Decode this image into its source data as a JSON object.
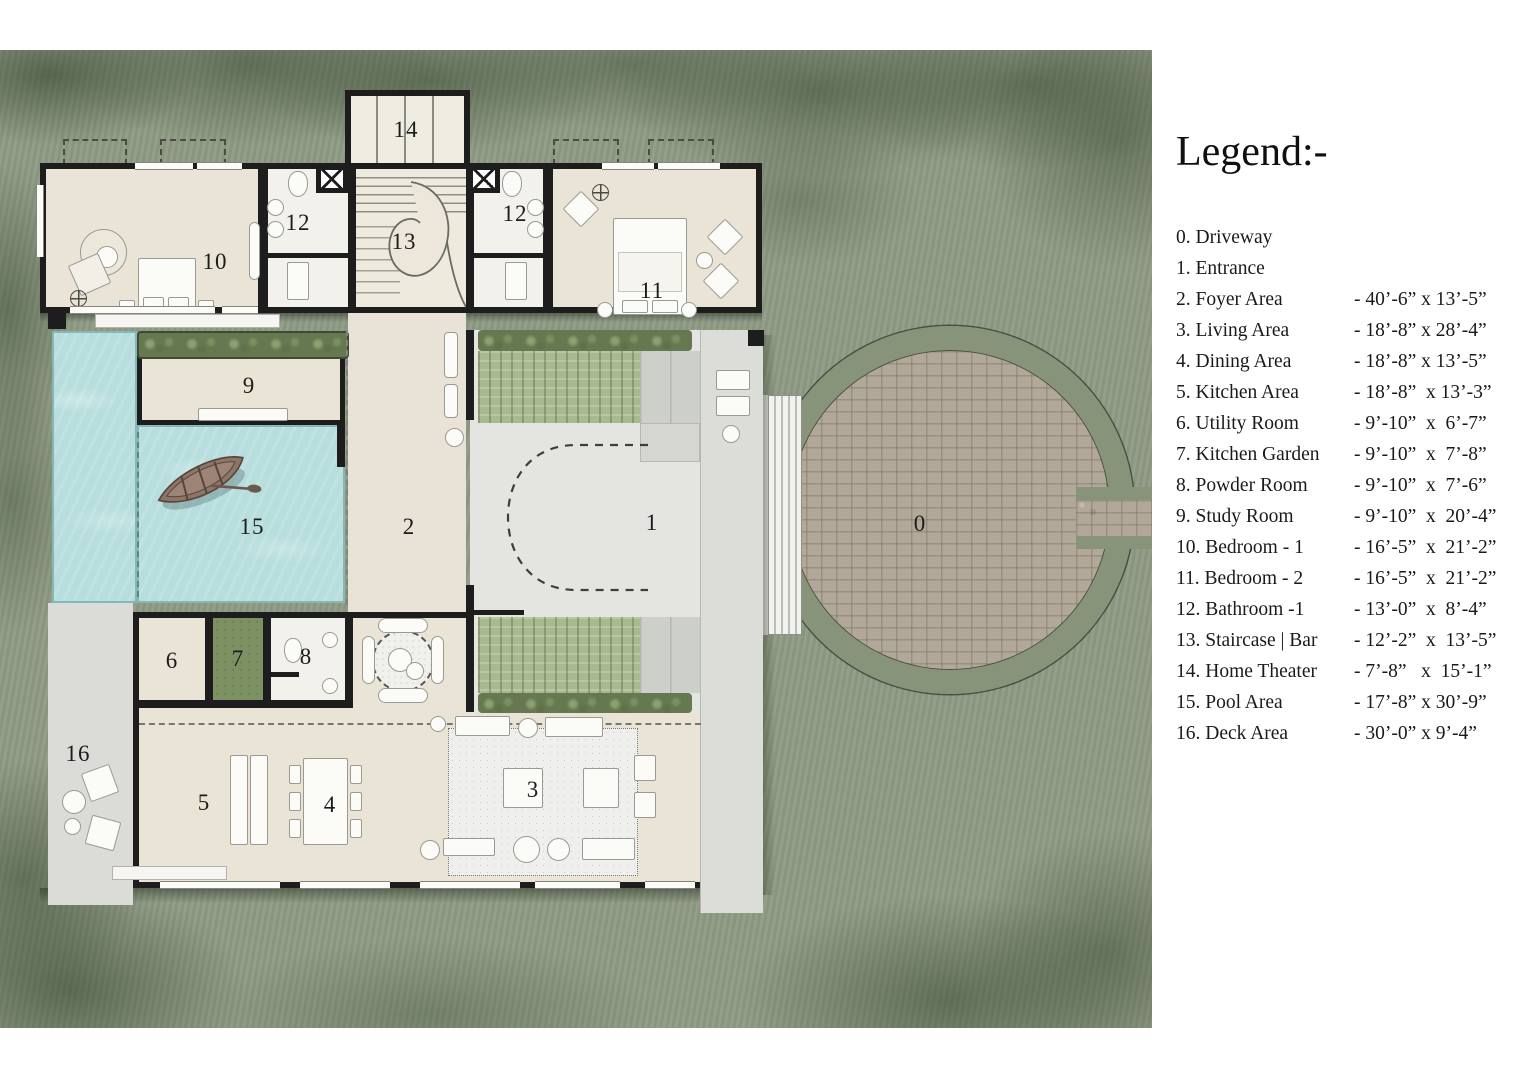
{
  "legend": {
    "title": "Legend:-",
    "items": [
      {
        "label": "0. Driveway",
        "dims": ""
      },
      {
        "label": "1. Entrance",
        "dims": ""
      },
      {
        "label": "2. Foyer Area",
        "dims": "- 40’-6” x 13’-5”"
      },
      {
        "label": "3. Living Area",
        "dims": "- 18’-8” x 28’-4”"
      },
      {
        "label": "4. Dining Area",
        "dims": "- 18’-8” x 13’-5”"
      },
      {
        "label": "5. Kitchen Area",
        "dims": "- 18’-8”  x 13’-3”"
      },
      {
        "label": "6. Utility Room",
        "dims": "- 9’-10”  x  6’-7”"
      },
      {
        "label": "7. Kitchen Garden",
        "dims": "- 9’-10”  x  7’-8”"
      },
      {
        "label": "8. Powder Room",
        "dims": "- 9’-10”  x  7’-6”"
      },
      {
        "label": "9. Study Room",
        "dims": "- 9’-10”  x  20’-4”"
      },
      {
        "label": "10. Bedroom - 1",
        "dims": "- 16’-5”  x  21’-2”"
      },
      {
        "label": "11. Bedroom - 2",
        "dims": "- 16’-5”  x  21’-2”"
      },
      {
        "label": "12. Bathroom -1",
        "dims": "- 13’-0”  x  8’-4”"
      },
      {
        "label": "13. Staircase | Bar",
        "dims": "- 12’-2”  x  13’-5”"
      },
      {
        "label": "14. Home Theater",
        "dims": "- 7’-8”   x  15’-1”"
      },
      {
        "label": "15. Pool Area",
        "dims": "- 17’-8” x 30’-9”"
      },
      {
        "label": "16. Deck Area",
        "dims": "- 30’-0” x 9’-4”"
      }
    ]
  },
  "plan_labels": [
    "14",
    "12",
    "13",
    "12",
    "10",
    "11",
    "9",
    "15",
    "2",
    "1",
    "0",
    "6",
    "7",
    "8",
    "16",
    "5",
    "4",
    "3"
  ],
  "colors": {
    "grass": "#8e9a84",
    "pool": "#b7dddd",
    "floor": "#e9e4d6",
    "wall": "#1d1d1d",
    "hedge": "#66784f",
    "lawn": "#a9b98e",
    "cobble": "#b2a89a",
    "driveway_ring": "#87947a",
    "plaza": "#dcddd9",
    "ink": "#1a1a1a"
  }
}
